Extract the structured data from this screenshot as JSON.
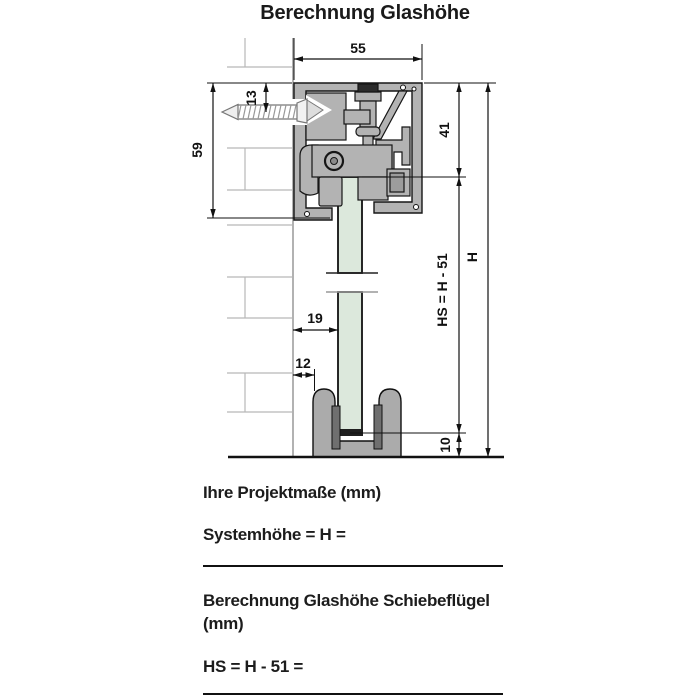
{
  "title": "Berechnung Glashöhe",
  "dims": {
    "track_width": "55",
    "screw_offset": "13",
    "profile_height": "59",
    "top_to_glass": "41",
    "wall_to_glass": "19",
    "wall_to_guide": "12",
    "bottom_gap": "10",
    "system_height": "H",
    "glass_height_formula": "HS = H - 51"
  },
  "form": {
    "project_heading": "Ihre Projektmaße (mm)",
    "system_height_label": "Systemhöhe = H =",
    "calc_heading_line1": "Berechnung Glashöhe Schiebeflügel",
    "calc_heading_line2": "(mm)",
    "glass_height_label": "HS = H - 51 ="
  },
  "colors": {
    "profile_gray": "#b3b3b3",
    "glass_green": "#dce8dc",
    "pad_dark": "#6f6f6f",
    "line_black": "#111111",
    "brick_gray": "#b8b8b8",
    "wall_gray": "#999999"
  }
}
